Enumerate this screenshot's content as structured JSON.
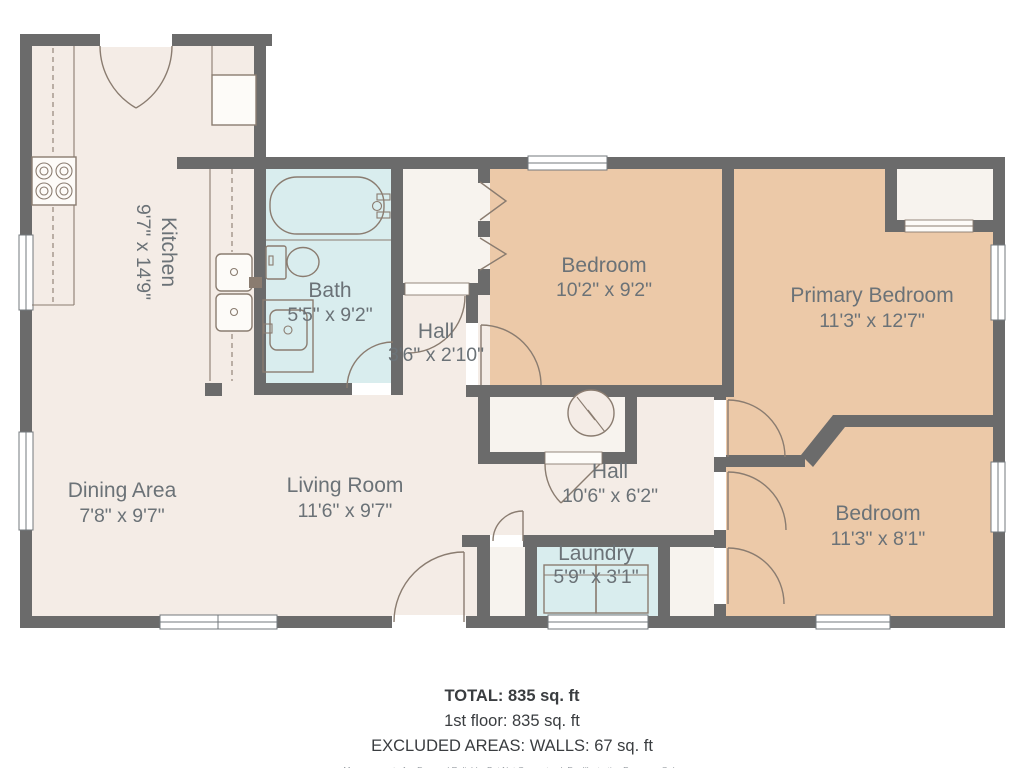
{
  "rooms": {
    "kitchen": {
      "name": "Kitchen",
      "dims": "9'7\" x 14'9\""
    },
    "bath": {
      "name": "Bath",
      "dims": "5'5\" x 9'2\""
    },
    "hall_small": {
      "name": "Hall",
      "dims": "3'6\" x 2'10\""
    },
    "bedroom_top": {
      "name": "Bedroom",
      "dims": "10'2\" x 9'2\""
    },
    "primary_bedroom": {
      "name": "Primary Bedroom",
      "dims": "11'3\" x 12'7\""
    },
    "dining": {
      "name": "Dining Area",
      "dims": "7'8\" x 9'7\""
    },
    "living": {
      "name": "Living Room",
      "dims": "11'6\" x 9'7\""
    },
    "hall_main": {
      "name": "Hall",
      "dims": "10'6\" x 6'2\""
    },
    "laundry": {
      "name": "Laundry",
      "dims": "5'9\" x 3'1\""
    },
    "bedroom_bottom": {
      "name": "Bedroom",
      "dims": "11'3\" x 8'1\""
    }
  },
  "summary": {
    "total": "TOTAL: 835 sq. ft",
    "floor1": "1st floor: 835 sq. ft",
    "excluded": "EXCLUDED AREAS: WALLS: 67 sq. ft",
    "disclaimer": "Measurements Are Deemed Reliable, But Not Guaranteed. For Illustrative Purposes Only."
  },
  "colors": {
    "wall": "#6b6b6b",
    "room_cream": "#f4ece6",
    "room_tan": "#ecc9a8",
    "room_blue": "#d9edee",
    "closet_white": "#f7f3ee",
    "fixture_stroke": "#8a7c70",
    "label_text": "#6b7277",
    "summary_text": "#3a3d40"
  }
}
